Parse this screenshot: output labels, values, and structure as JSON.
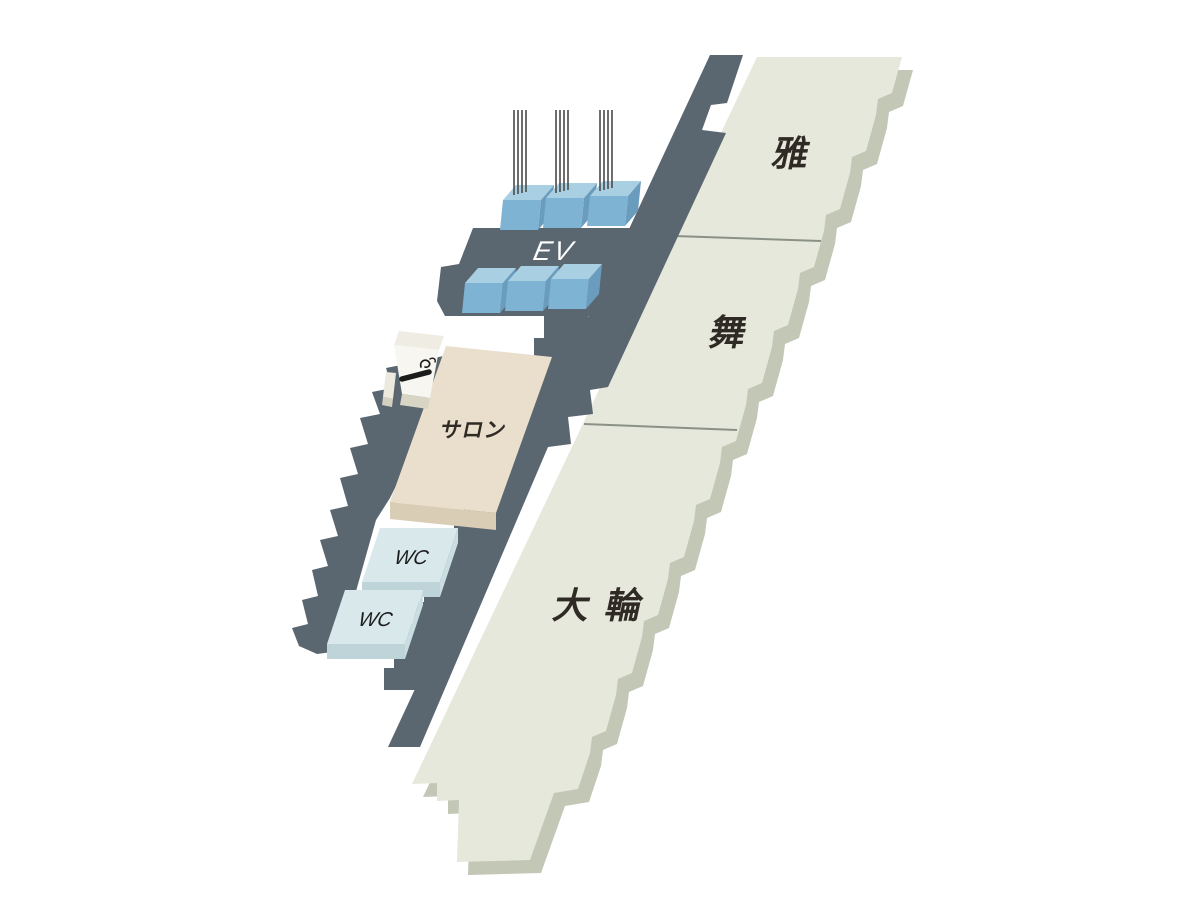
{
  "map": {
    "type": "isometric-floor-guide",
    "background": "#ffffff"
  },
  "rooms": [
    {
      "id": "miyabi",
      "label": "雅"
    },
    {
      "id": "mai",
      "label": "舞"
    },
    {
      "id": "dairin",
      "label": "大 輪"
    }
  ],
  "facilities": {
    "salon": {
      "label": "サロン"
    },
    "wc_upper": {
      "label": "WC"
    },
    "wc_lower": {
      "label": "WC"
    },
    "elevator_hall": {
      "label": "EV",
      "cabs_top_row": 3,
      "cabs_bottom_row": 3
    },
    "smoking_area": {
      "icon": "cigarette-icon"
    }
  },
  "colors": {
    "corridor": "#5a6670",
    "room_top": "#e5e8da",
    "room_side": "#c3c7b6",
    "divider": "#8b9186",
    "elevator_top": "#a9cfe3",
    "elevator_front": "#7fb3d3",
    "elevator_side": "#6a9cbe",
    "cable": "#4a4a4a",
    "salon_top": "#eadfcc",
    "salon_side": "#d9cdb5",
    "wc_top": "#d8e8eb",
    "wc_side": "#bed4d9",
    "smoking_block": "#f7f6f0",
    "label": "#2f2b24",
    "ev_text": "#ffffff"
  }
}
